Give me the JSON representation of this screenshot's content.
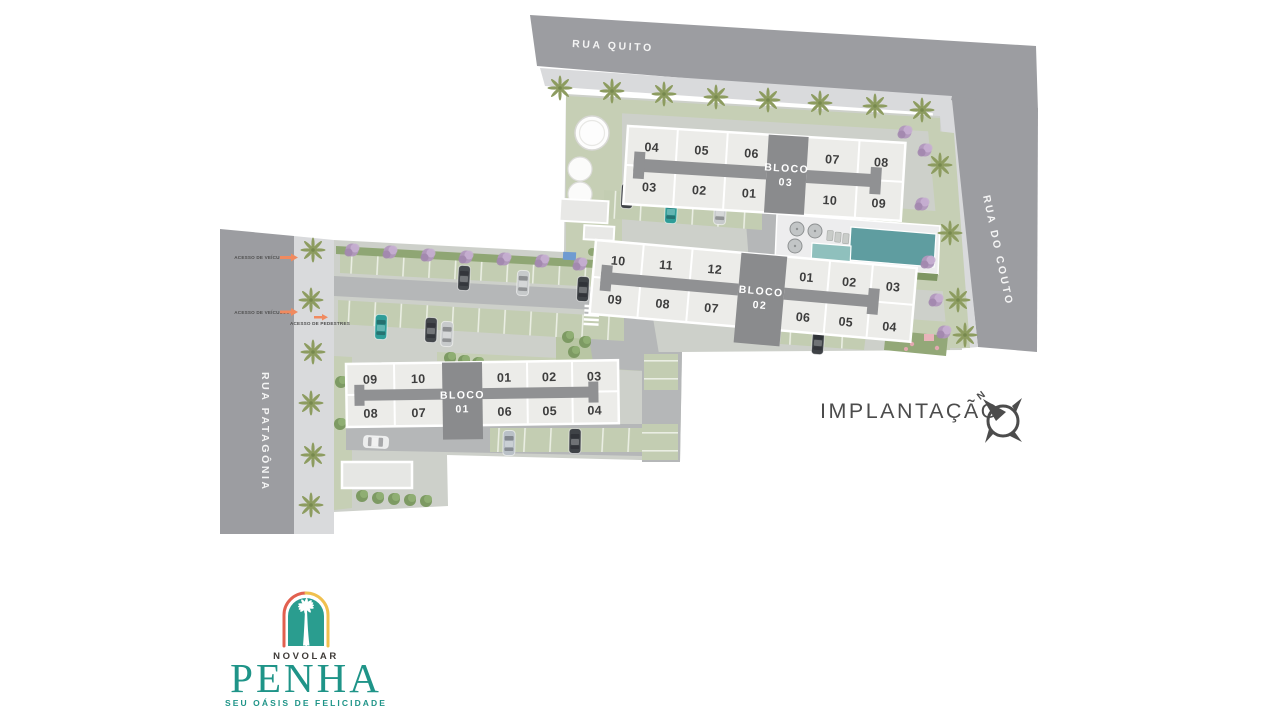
{
  "title": "IMPLANTAÇÃO",
  "compass": {
    "north": "N"
  },
  "streets": {
    "top": "RUA QUITO",
    "right": "RUA DO COUTO",
    "left": "RUA PATAGÔNIA"
  },
  "access": {
    "vehicles_north": "ACESSO DE VEÍCULOS",
    "vehicles_south": "ACESSO DE VEÍCULOS",
    "pedestrians": "ACESSO DE PEDESTRES"
  },
  "blocks": {
    "bloco03": {
      "label": "BLOCO",
      "number": "03",
      "units_top_left": [
        "04",
        "05",
        "06"
      ],
      "units_top_right": [
        "07",
        "08"
      ],
      "units_bottom_left": [
        "03",
        "02",
        "01"
      ],
      "units_bottom_right": [
        "10",
        "09"
      ]
    },
    "bloco02": {
      "label": "BLOCO",
      "number": "02",
      "units_top_left": [
        "10",
        "11",
        "12"
      ],
      "units_top_right": [
        "01",
        "02",
        "03"
      ],
      "units_bottom_left": [
        "09",
        "08",
        "07"
      ],
      "units_bottom_right": [
        "06",
        "05",
        "04"
      ]
    },
    "bloco01": {
      "label": "BLOCO",
      "number": "01",
      "units_top_left": [
        "09",
        "10"
      ],
      "units_top_right": [
        "01",
        "02",
        "03"
      ],
      "units_bottom_left": [
        "08",
        "07"
      ],
      "units_bottom_right": [
        "06",
        "05",
        "04"
      ]
    }
  },
  "logo": {
    "brand": "NOVOLAR",
    "name": "PENHA",
    "tagline": "SEU OÁSIS DE FELICIDADE"
  },
  "colors": {
    "street": "#9c9da1",
    "sidewalk": "#d9dadc",
    "ground": "#cdd0ca",
    "lawn": "#c6cfb5",
    "hedge": "#8fa674",
    "road": "#b5b7b8",
    "building": "#ecece9",
    "building_core": "#8a8b8d",
    "pool_light": "#8fc0bd",
    "pool_dark": "#5f9da0",
    "palm": "#8d9c60",
    "purple_tree": "#b197bd",
    "accent_teal": "#1f9488",
    "logo_red": "#e2604f",
    "logo_yellow": "#f0c04e",
    "arrow_orange": "#f08a5f",
    "title_text": "#4c4c4c"
  }
}
